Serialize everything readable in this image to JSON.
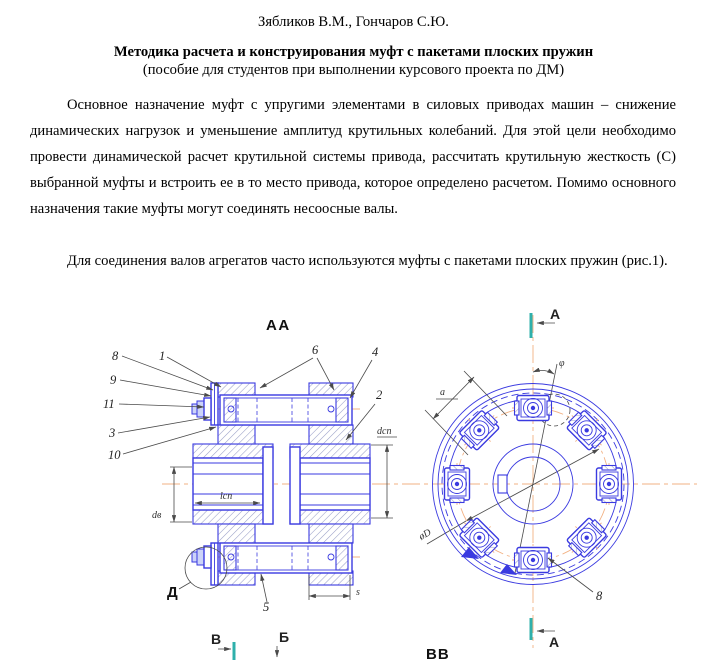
{
  "doc": {
    "authors": "Зябликов В.М., Гончаров С.Ю.",
    "title": "Методика расчета и конструирования муфт с пакетами плоских пружин",
    "subtitle": "(пособие для студентов при выполнении курсового проекта по ДМ)",
    "para1": "Основное назначение муфт с упругими элементами в силовых приводах машин – снижение динамических нагрузок и уменьшение амплитуд крутильных колебаний. Для этой цели необходимо провести динамической расчет крутильной системы привода, рассчитать крутильную жесткость (С) выбранной муфты и встроить ее в то место привода, которое определено расчетом. Помимо основного назначения такие муфты могут соединять несоосные валы.",
    "para2": "Для соединения валов агрегатов часто используются муфты с пакетами плоских пружин (рис.1)."
  },
  "figure": {
    "section_label_left": "АА",
    "section_label_right": "ВВ",
    "detail_label": "Д",
    "marks": {
      "a_top": "А",
      "a_bottom": "А",
      "v": "В",
      "b": "Б"
    },
    "callouts": {
      "c1": "1",
      "c2": "2",
      "c3": "3",
      "c4": "4",
      "c5": "5",
      "c6": "6",
      "c8": "8",
      "c9": "9",
      "c10": "10",
      "c11": "11",
      "c8_right": "8"
    },
    "dims": {
      "d_sp": "dсп",
      "d_v": "dв",
      "l_sp": "lсп",
      "s": "s",
      "a": "а",
      "phi": "φ",
      "diameter": "øD"
    },
    "colors": {
      "line_blue": "#3a3ae0",
      "centerline_orange": "#f2b183",
      "section_teal": "#2fb0ab",
      "dimension_gray": "#4a4a4a",
      "hatch": "#9aa0c8"
    }
  }
}
